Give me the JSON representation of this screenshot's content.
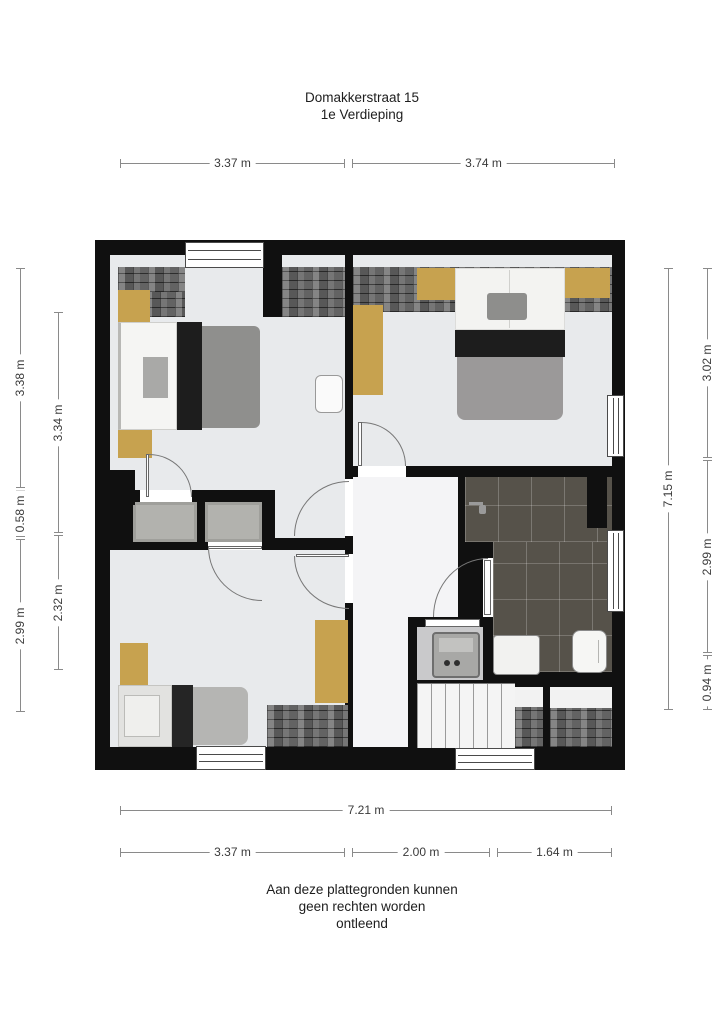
{
  "title": {
    "address": "Domakkerstraat 15",
    "floor": "1e Verdieping"
  },
  "disclaimer": {
    "line1": "Aan deze plattegronden kunnen",
    "line2": "geen rechten worden",
    "line3": "ontleend"
  },
  "dimensions": {
    "top": [
      {
        "label": "3.37 m"
      },
      {
        "label": "3.74 m"
      }
    ],
    "bottom_total": {
      "label": "7.21 m"
    },
    "bottom": [
      {
        "label": "3.37 m"
      },
      {
        "label": "2.00 m"
      },
      {
        "label": "1.64 m"
      }
    ],
    "left_outer": [
      {
        "label": "3.38 m"
      },
      {
        "label": "0.58 m"
      },
      {
        "label": "2.99 m"
      }
    ],
    "left_inner": [
      {
        "label": "3.34 m"
      },
      {
        "label": "2.32 m"
      }
    ],
    "right_inner": [
      {
        "label": "7.15 m"
      }
    ],
    "right_outer": [
      {
        "label": "3.02 m"
      },
      {
        "label": "2.99 m"
      },
      {
        "label": "0.94 m"
      }
    ]
  },
  "colors": {
    "wall": "#101010",
    "room_floor": "#e8eaec",
    "hall_floor": "#f4f4f6",
    "bathroom_tile": "#56524a",
    "wardrobe_tan": "#c7a24f",
    "cupboard_gray": "#b2b2ae"
  }
}
